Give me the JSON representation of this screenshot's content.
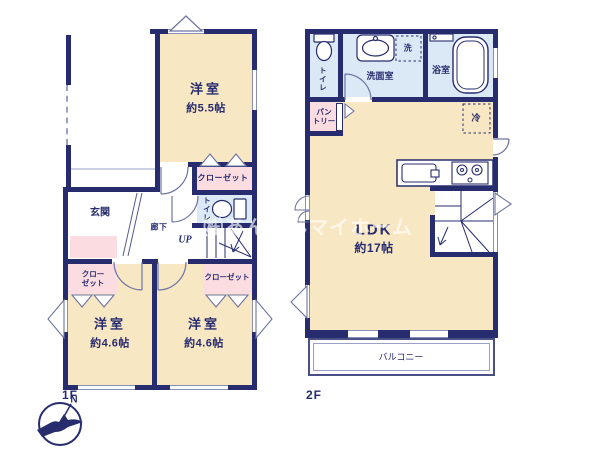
{
  "watermark": "㈱あんしんマイホーム",
  "compass": {
    "north_label": "N"
  },
  "colors": {
    "wall": "#272c6e",
    "room_fill": "#f8e7c3",
    "closet_fill": "#fbdce0",
    "water_room_fill": "#dbe8f5",
    "text": "#272c6e",
    "watermark_text": "rgba(255,255,255,0.65)"
  },
  "floor1": {
    "label": "1F",
    "bedroom_top": {
      "name": "洋室",
      "area": "約5.5帖"
    },
    "closet_top": {
      "label": "クローゼット"
    },
    "toilet": {
      "label": "トイレ"
    },
    "entrance": {
      "label": "玄関"
    },
    "hallway": {
      "label": "廊下"
    },
    "stairs": {
      "label": "UP"
    },
    "closet_left": {
      "line1": "クロー",
      "line2": "ゼット"
    },
    "closet_right": {
      "label": "クローゼット"
    },
    "bedroom_left": {
      "name": "洋室",
      "area": "約4.6帖"
    },
    "bedroom_right": {
      "name": "洋室",
      "area": "約4.6帖"
    }
  },
  "floor2": {
    "label": "2F",
    "toilet": {
      "label": "トイレ"
    },
    "washroom": {
      "label": "洗面室"
    },
    "washer": {
      "label": "洗"
    },
    "bathroom": {
      "label": "浴室"
    },
    "pantry": {
      "line1": "パン",
      "line2": "トリー"
    },
    "refrigerator": {
      "label": "冷"
    },
    "ldk": {
      "name": "LDK",
      "area": "約17帖"
    },
    "balcony": {
      "label": "バルコニー"
    }
  }
}
